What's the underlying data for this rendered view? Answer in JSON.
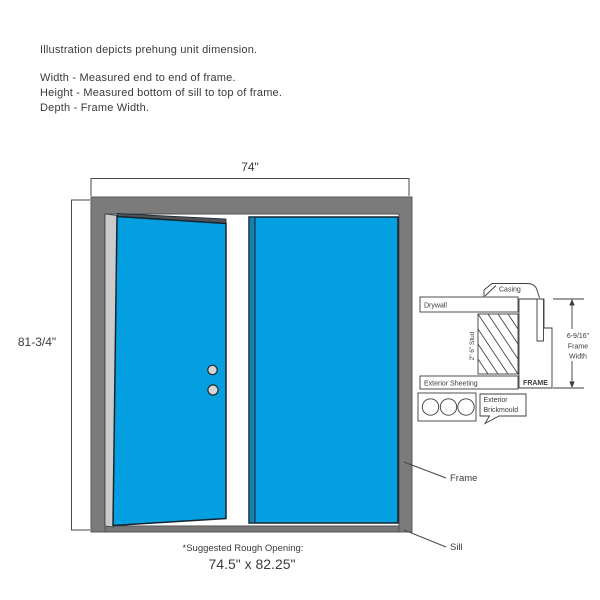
{
  "intro": {
    "title": "Illustration depicts prehung unit dimension.",
    "width_note": "Width - Measured end to end of frame.",
    "height_note": "Height - Measured bottom of sill to top of frame.",
    "depth_note": "Depth - Frame Width."
  },
  "unit_dimensions": {
    "width": "74\"",
    "height": "81-3/4\""
  },
  "rough_opening": {
    "note": "*Suggested Rough Opening:",
    "size": "74.5\" x 82.25\""
  },
  "callouts": {
    "frame": "Frame",
    "sill": "Sill"
  },
  "cross_section": {
    "casing": "Casing",
    "drywall": "Drywall",
    "stud": "2\" 6\" Stud",
    "exterior_sheeting": "Exterior Sheeting",
    "frame": "FRAME",
    "brickmould_line1": "Exterior",
    "brickmould_line2": "Brickmould",
    "frame_width_value": "6-9/16\"",
    "frame_width_line2": "Frame",
    "frame_width_line3": "Width"
  },
  "colors": {
    "door_blue": "#039FE0",
    "door_edge_blue": "#1B7FB2",
    "frame_gray": "#7B7B7B",
    "sill_gray": "#777777",
    "hinge_strip_gray": "#C9CBCD",
    "door_top_edge_gray": "#4E5357",
    "line_color": "#4A4A4A",
    "text_color": "#3B3B3B"
  }
}
